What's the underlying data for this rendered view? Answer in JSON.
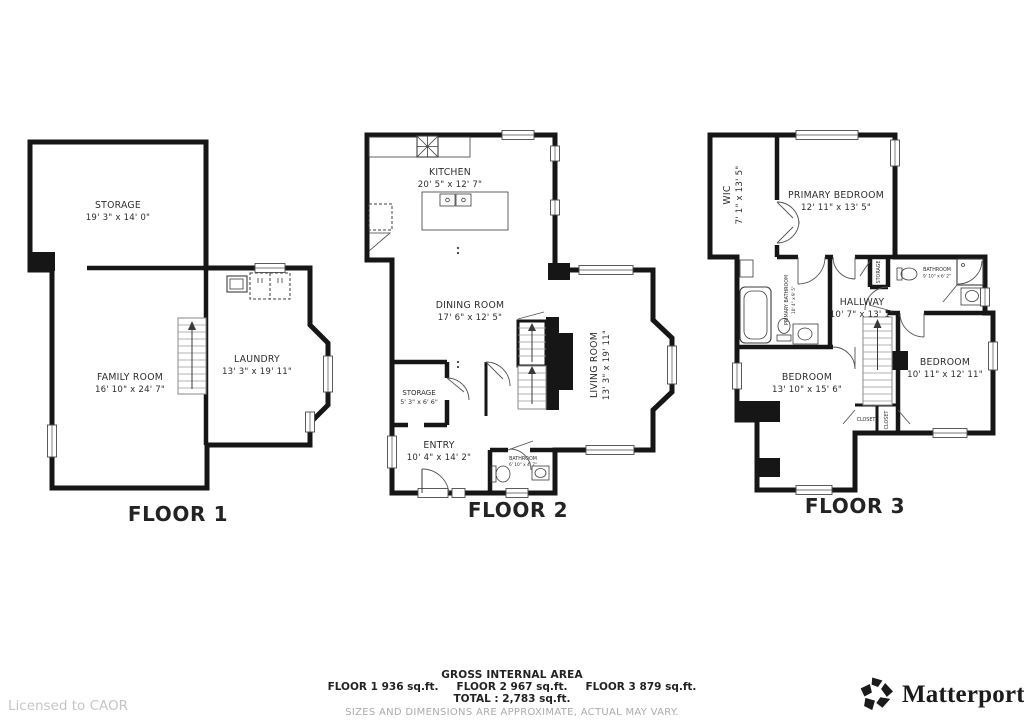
{
  "floors": [
    {
      "label": "FLOOR 1",
      "rooms": {
        "storage": {
          "name": "STORAGE",
          "dims": "19' 3\" x 14' 0\""
        },
        "family_room": {
          "name": "FAMILY ROOM",
          "dims": "16' 10\" x 24' 7\""
        },
        "laundry": {
          "name": "LAUNDRY",
          "dims": "13' 3\" x 19' 11\""
        }
      }
    },
    {
      "label": "FLOOR 2",
      "rooms": {
        "kitchen": {
          "name": "KITCHEN",
          "dims": "20' 5\" x 12' 7\""
        },
        "dining_room": {
          "name": "DINING ROOM",
          "dims": "17' 6\" x 12' 5\""
        },
        "living_room": {
          "name": "LIVING ROOM",
          "dims": "13' 3\" x 19' 11\""
        },
        "storage": {
          "name": "STORAGE",
          "dims": "5' 3\" x 6' 6\""
        },
        "entry": {
          "name": "ENTRY",
          "dims": "10' 4\" x 14' 2\""
        },
        "bathroom": {
          "name": "BATHROOM",
          "dims": "6' 10\" x 4' 7\""
        }
      }
    },
    {
      "label": "FLOOR 3",
      "rooms": {
        "wic": {
          "name": "WIC",
          "dims": "7' 1\" x 13' 5\""
        },
        "primary_bedroom": {
          "name": "PRIMARY BEDROOM",
          "dims": "12' 11\" x 13' 5\""
        },
        "primary_bathroom": {
          "name": "PRIMARY BATHROOM",
          "dims": "10' 4\" x 9' 5\""
        },
        "hallway": {
          "name": "HALLWAY",
          "dims": "10' 7\" x 13' 1\""
        },
        "bathroom": {
          "name": "BATHROOM",
          "dims": "9' 10\" x 6' 2\""
        },
        "bedroom_left": {
          "name": "BEDROOM",
          "dims": "13' 10\" x 15' 6\""
        },
        "bedroom_right": {
          "name": "BEDROOM",
          "dims": "10' 11\" x 12' 11\""
        },
        "closet_left": {
          "name": "CLOSET"
        },
        "closet_right": {
          "name": "CLOSET"
        },
        "hall_storage": {
          "name": "STORAGE"
        }
      }
    }
  ],
  "footer": {
    "title": "GROSS INTERNAL AREA",
    "areas": [
      "FLOOR 1 936 sq.ft.",
      "FLOOR 2 967 sq.ft.",
      "FLOOR 3 879 sq.ft."
    ],
    "total": "TOTAL :  2,783 sq.ft.",
    "disclaimer": "SIZES AND DIMENSIONS ARE APPROXIMATE, ACTUAL MAY VARY."
  },
  "license": "Licensed to CAOR",
  "brand": {
    "name": "Matterport",
    "mark": "™"
  },
  "colors": {
    "wall": "#161616",
    "text": "#2d2d2d",
    "disclaimer": "#ababab",
    "license": "#c6c6c6"
  }
}
